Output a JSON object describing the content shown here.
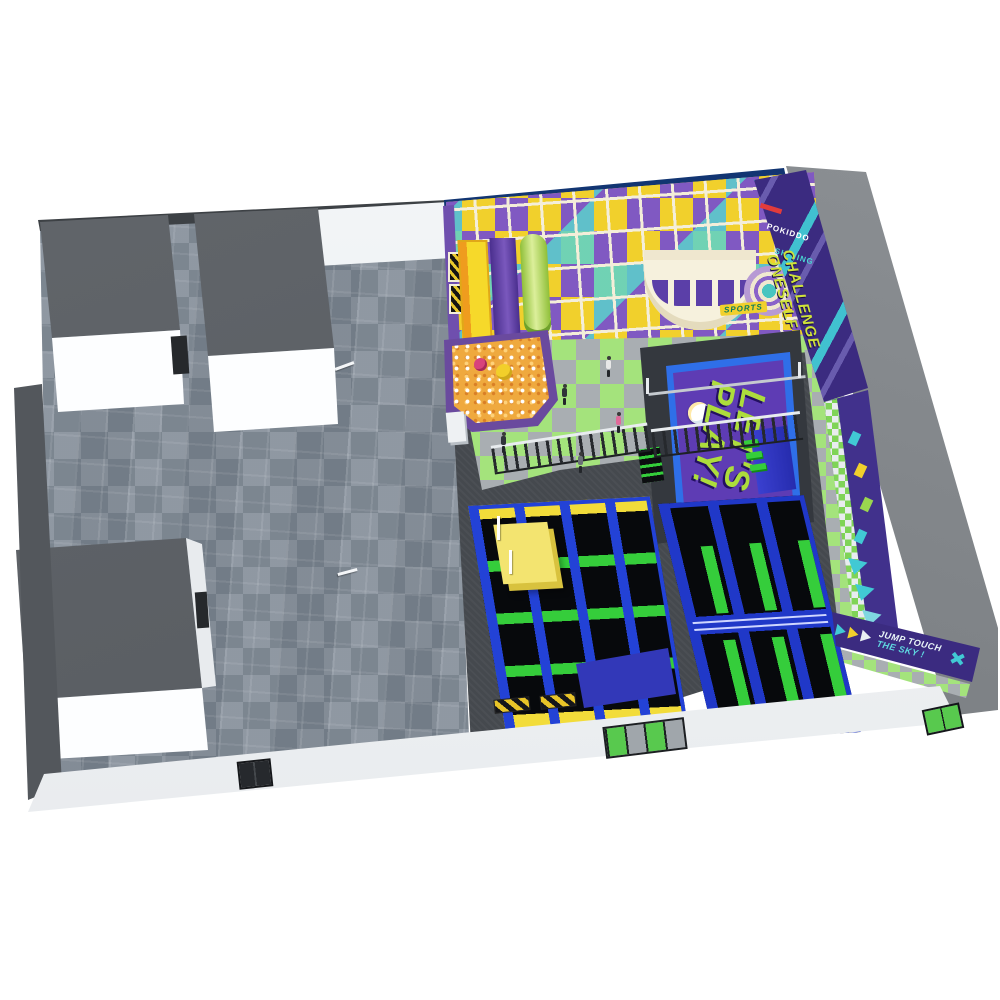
{
  "signs": {
    "top_banner": "LET'S PLAY!",
    "top_banner_secondary": "LET'S",
    "court_floor_line1": "LET'S",
    "court_floor_line2": "PLAY!",
    "challenge_wall_line1": "CHALLENGE",
    "challenge_wall_line2": "ONESELF",
    "brand_wall_name": "POKIDDO",
    "brand_wall_sub": "SHINING",
    "equipment_badge": "SPORTS",
    "jump_wall_line1": "JUMP TOUCH",
    "jump_wall_line2": "THE SKY !"
  },
  "icons": {
    "jump_wall_logo": "crossed-arrows",
    "jump_wall_arrows": "chevron-right",
    "corner_wall_arrows": "chevron-down"
  },
  "colors": {
    "banner_wall_blue": "#123572",
    "structure_purple": "#8059c2",
    "structure_yellow": "#f1d02c",
    "structure_frame_beige": "#f4eed9",
    "play_floor_green": "#a4e37c",
    "play_floor_gray": "#a9aeb2",
    "trampoline_frame_blue": "#2342d6",
    "trampoline_bed_black": "#07090c",
    "pad_green": "#35cd3b",
    "pad_yellow": "#f2dc3a",
    "court_mat_purple": "#4f2f9e",
    "court_text_green": "#addd3c",
    "feature_wall_purple": "#3b2b80",
    "stripe_teal": "#41c9d4",
    "carpet_gray_blue": "#8a939e",
    "roof_gray": "#84888c",
    "room_roof_gray": "#595d62",
    "wall_white": "#f3f5f7",
    "ballpit_orange": "#efa93e"
  }
}
